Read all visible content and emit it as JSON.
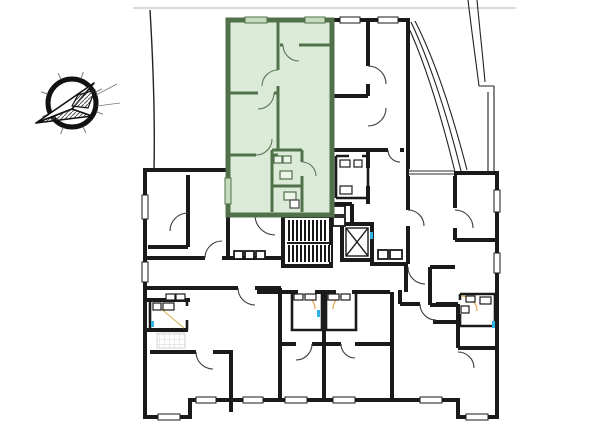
{
  "canvas": {
    "width": 600,
    "height": 440,
    "background": "#ffffff"
  },
  "colors": {
    "wall_black": "#1a1a1a",
    "thin_line": "#2e2e2e",
    "site_gray": "#cfcfcf",
    "unit_fill": "#dcead8",
    "unit_wall": "#50714a",
    "unit_window": "#c7dcbc",
    "unit_fixture_fill": "#edf4ea",
    "accent_orange": "#e8a64c",
    "accent_yellow": "#d9c26a",
    "accent_cyan": "#2fb2e6",
    "tile_gray": "#c9c9c9",
    "paper_white": "#ffffff"
  },
  "compass": {
    "icon": "north-arrow-compass-icon",
    "pointing": "southwest"
  },
  "plan": {
    "type": "apartment-floor-plan",
    "highlighted_unit": {
      "state": "selected",
      "fill": "#dcead8",
      "wall": "#50714a"
    },
    "core": {
      "staircase": "hatched-double-flight",
      "elevator": "x-box"
    }
  }
}
